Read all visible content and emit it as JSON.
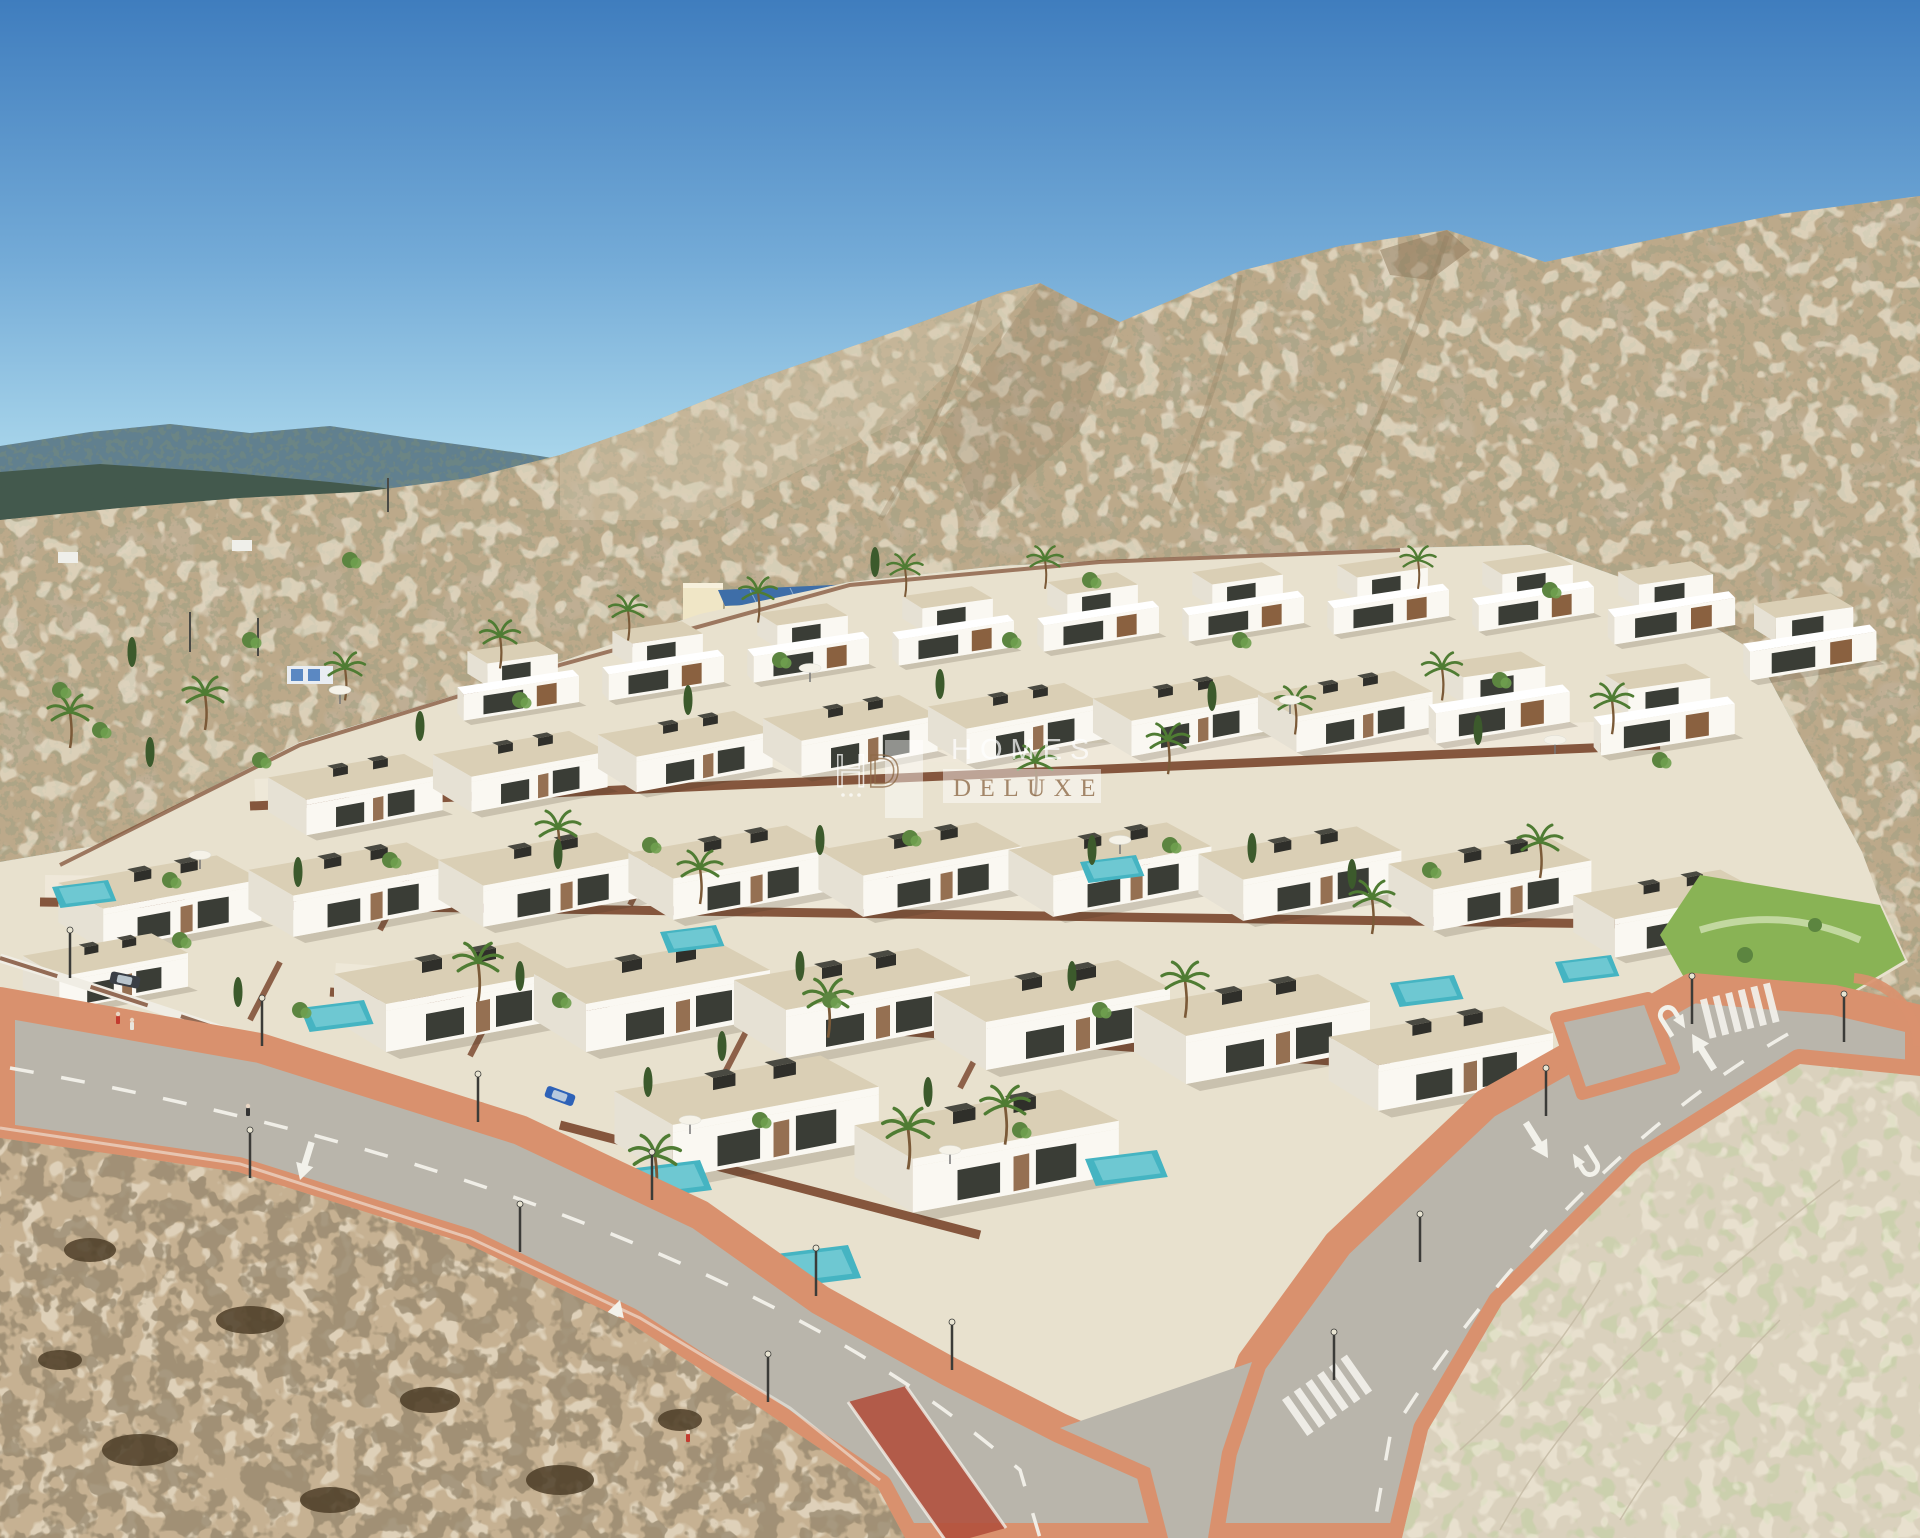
{
  "watermark": {
    "logo_h": "H",
    "logo_d": "D",
    "line1": "HOMES",
    "line2": "DELUXE"
  },
  "palette": {
    "sky_top": "#3F7DBE",
    "sky_mid": "#74ABD7",
    "sky_low": "#A9D6EB",
    "mtn_far": "#61808F",
    "mtn_near": "#41564A",
    "hill_sand": "#BCA98A",
    "hill_sand_light": "#D8CCB2",
    "hill_sand_dark": "#8F7B5E",
    "hill_scrub": "#6B6847",
    "hill_rock": "#8C7658",
    "dev_ground": "#E8E1CE",
    "inner_street": "#EFE9DA",
    "villa_wall": "#FAF8F2",
    "villa_wall_shade": "#E6E1D4",
    "villa_roof": "#DACFB5",
    "villa_window": "#3A3D36",
    "villa_wood": "#8A6140",
    "perimeter_wall": "#7C4A31",
    "front_wall_white": "#F0EDE4",
    "pool": "#45B4C2",
    "pool_light": "#8AD6DC",
    "road": "#B9B5AB",
    "sidewalk": "#D9916E",
    "bike_lane": "#B14F3B",
    "marking": "#F2F1EA",
    "sand_fg": "#C6B192",
    "scrub_dark": "#4E3E28",
    "bush": "#5C8540",
    "cypress": "#3C5A2C",
    "lawn": "#89B355",
    "palm_leaf": "#4F7C33",
    "trunk": "#7B5A38",
    "building_wall": "#F0E6C6",
    "building_roof": "#3E6EA8",
    "flag_red": "#C0392B",
    "watermark_white": "#FFFFFF",
    "watermark_brown": "#8F6C49"
  }
}
